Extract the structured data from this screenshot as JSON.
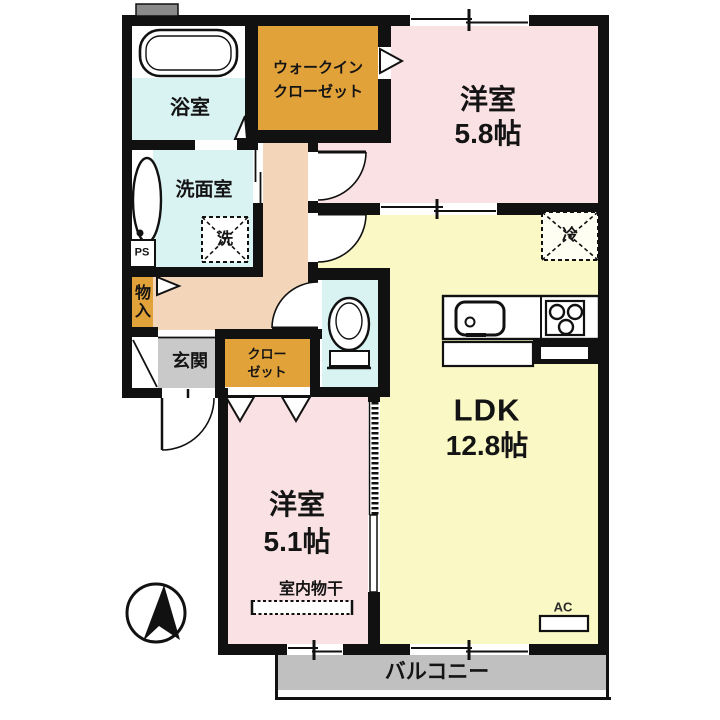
{
  "plan": {
    "bathroom": "浴室",
    "walkin_closet_line1": "ウォークイン",
    "walkin_closet_line2": "クローゼット",
    "bedroom1_name": "洋室",
    "bedroom1_size": "5.8帖",
    "washroom": "洗面室",
    "washer_symbol": "洗",
    "pipe_space": "PS",
    "storage": "物入",
    "entrance": "玄関",
    "closet_line1": "クロー",
    "closet_line2": "ゼット",
    "ldk_name": "LDK",
    "ldk_size": "12.8帖",
    "fridge_symbol": "冷",
    "bedroom2_name": "洋室",
    "bedroom2_size": "5.1帖",
    "indoor_drying": "室内物干",
    "ac_label": "AC",
    "balcony": "バルコニー"
  },
  "colors": {
    "room_pink": "#fae2e4",
    "ldk_yellow": "#faf8c5",
    "wet_cyan": "#d9f2f2",
    "closet_orange": "#e2a23a",
    "hall_tan": "#f3d6ba",
    "entrance_gray": "#c9c9c9",
    "balcony_gray": "#c0c0c0",
    "wall_black": "#111111"
  }
}
